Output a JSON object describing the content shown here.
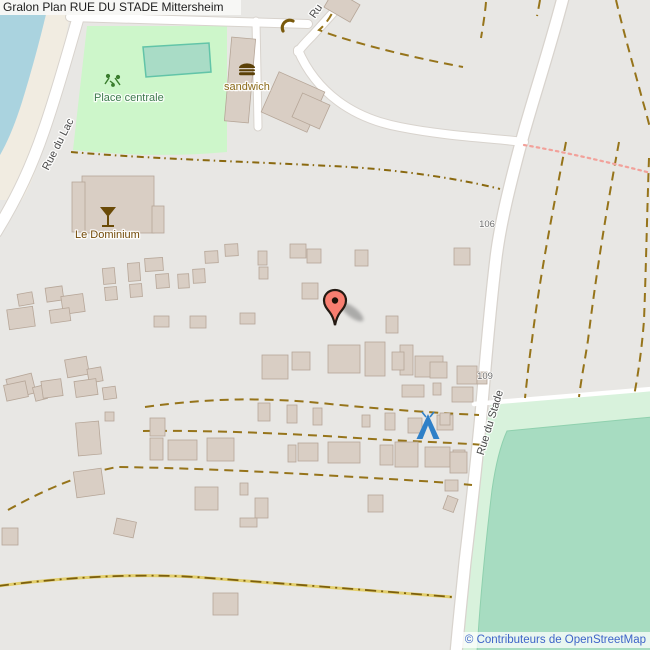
{
  "header": {
    "title": "Gralon Plan RUE DU STADE Mittersheim"
  },
  "attribution": {
    "text": "© Contributeurs de OpenStreetMap"
  },
  "map": {
    "labels": {
      "park": "Place centrale",
      "fast_food": "sandwich",
      "bar": "Le Dominium",
      "street_lac": "Rue du Lac",
      "street_stade": "Rue du Stade",
      "street_partial": "Ru",
      "housenumber_106": "106",
      "housenumber_109": "109"
    },
    "icons": {
      "marker": "map-pin",
      "campsite": "tent",
      "bar": "cocktail-glass",
      "fast_food": "burger",
      "phone": "telephone",
      "playground": "playground"
    },
    "colors": {
      "background": "#e8e7e4",
      "water": "#aad3df",
      "beach": "#f1ece1",
      "park": "#cdf6ca",
      "pitch_fill": "#a9dcc6",
      "pitch_stroke": "#62c4a8",
      "field_outer": "#d8f2dc",
      "field_inner": "#a7dcc1",
      "road": "#ffffff",
      "road_casing": "#d8d3cd",
      "building_fill": "#d9cec4",
      "building_stroke": "#b6a698",
      "path_dashed": "#96741a",
      "track_yellow": "#e3cf6d",
      "path_pink": "#f2a19a",
      "marker_fill": "#f87e70",
      "marker_stroke": "#241a12",
      "campsite_blue": "#2f80c8",
      "attribution_text": "#3d64c8"
    },
    "buildings": [
      [
        228,
        38,
        24,
        84,
        5
      ],
      [
        268,
        80,
        50,
        44,
        24
      ],
      [
        296,
        98,
        30,
        26,
        24
      ],
      [
        327,
        -4,
        30,
        20,
        30
      ],
      [
        82,
        176,
        72,
        57,
        0
      ],
      [
        72,
        182,
        13,
        50,
        0
      ],
      [
        152,
        206,
        12,
        27,
        0
      ],
      [
        18,
        293,
        15,
        12,
        -10
      ],
      [
        8,
        308,
        26,
        20,
        -8
      ],
      [
        46,
        287,
        17,
        14,
        -8
      ],
      [
        62,
        295,
        22,
        18,
        -8
      ],
      [
        50,
        309,
        20,
        13,
        -8
      ],
      [
        103,
        268,
        12,
        16,
        -5
      ],
      [
        105,
        287,
        12,
        13,
        -5
      ],
      [
        128,
        263,
        12,
        18,
        -4
      ],
      [
        130,
        284,
        12,
        13,
        -4
      ],
      [
        145,
        258,
        18,
        13,
        -4
      ],
      [
        156,
        274,
        13,
        14,
        -4
      ],
      [
        178,
        274,
        11,
        14,
        -3
      ],
      [
        193,
        269,
        12,
        14,
        -3
      ],
      [
        205,
        251,
        13,
        12,
        -3
      ],
      [
        225,
        244,
        13,
        12,
        -3
      ],
      [
        258,
        251,
        9,
        14,
        0
      ],
      [
        259,
        267,
        9,
        12,
        0
      ],
      [
        290,
        244,
        16,
        14,
        0
      ],
      [
        307,
        249,
        14,
        14,
        0
      ],
      [
        355,
        250,
        13,
        16,
        0
      ],
      [
        454,
        248,
        16,
        17,
        0
      ],
      [
        154,
        316,
        15,
        11,
        0
      ],
      [
        190,
        316,
        16,
        12,
        0
      ],
      [
        240,
        313,
        15,
        11,
        0
      ],
      [
        302,
        283,
        16,
        16,
        0
      ],
      [
        386,
        316,
        12,
        17,
        0
      ],
      [
        66,
        358,
        22,
        18,
        -10
      ],
      [
        88,
        368,
        14,
        14,
        -10
      ],
      [
        8,
        376,
        26,
        20,
        -14
      ],
      [
        34,
        386,
        12,
        14,
        -14
      ],
      [
        5,
        383,
        22,
        16,
        -12
      ],
      [
        42,
        380,
        20,
        17,
        -8
      ],
      [
        75,
        380,
        22,
        16,
        -8
      ],
      [
        103,
        387,
        13,
        12,
        -8
      ],
      [
        262,
        355,
        26,
        24,
        0
      ],
      [
        292,
        352,
        18,
        18,
        0
      ],
      [
        328,
        345,
        32,
        28,
        0
      ],
      [
        365,
        342,
        20,
        34,
        0
      ],
      [
        400,
        345,
        13,
        30,
        0
      ],
      [
        415,
        356,
        28,
        21,
        0
      ],
      [
        457,
        366,
        20,
        18,
        0
      ],
      [
        477,
        372,
        10,
        12,
        0
      ],
      [
        392,
        352,
        12,
        18,
        0
      ],
      [
        430,
        362,
        17,
        16,
        0
      ],
      [
        433,
        383,
        8,
        12,
        0
      ],
      [
        402,
        385,
        22,
        12,
        0
      ],
      [
        458,
        388,
        13,
        12,
        0
      ],
      [
        150,
        418,
        15,
        18,
        0
      ],
      [
        258,
        403,
        12,
        18,
        0
      ],
      [
        287,
        405,
        10,
        18,
        0
      ],
      [
        313,
        408,
        9,
        17,
        0
      ],
      [
        362,
        415,
        8,
        12,
        0
      ],
      [
        385,
        413,
        10,
        17,
        0
      ],
      [
        408,
        418,
        14,
        15,
        0
      ],
      [
        437,
        415,
        16,
        15,
        0
      ],
      [
        150,
        438,
        13,
        22,
        0
      ],
      [
        168,
        440,
        29,
        20,
        0
      ],
      [
        207,
        438,
        27,
        23,
        0
      ],
      [
        288,
        445,
        8,
        17,
        0
      ],
      [
        298,
        443,
        20,
        18,
        0
      ],
      [
        328,
        442,
        32,
        21,
        0
      ],
      [
        380,
        445,
        13,
        20,
        0
      ],
      [
        395,
        442,
        23,
        25,
        0
      ],
      [
        425,
        447,
        25,
        20,
        0
      ],
      [
        453,
        450,
        12,
        17,
        0
      ],
      [
        77,
        422,
        23,
        33,
        -5
      ],
      [
        105,
        412,
        9,
        9,
        0
      ],
      [
        75,
        470,
        28,
        26,
        -8
      ],
      [
        115,
        520,
        20,
        16,
        12
      ],
      [
        2,
        528,
        16,
        17,
        0
      ],
      [
        195,
        487,
        23,
        23,
        0
      ],
      [
        240,
        483,
        8,
        12,
        0
      ],
      [
        255,
        498,
        13,
        20,
        0
      ],
      [
        368,
        495,
        15,
        17,
        0
      ],
      [
        445,
        497,
        11,
        14,
        20
      ],
      [
        445,
        480,
        13,
        11,
        0
      ],
      [
        450,
        452,
        17,
        21,
        0
      ],
      [
        452,
        387,
        21,
        15,
        0
      ],
      [
        440,
        413,
        10,
        12,
        0
      ],
      [
        240,
        518,
        17,
        9,
        0
      ],
      [
        213,
        593,
        25,
        22,
        0
      ]
    ]
  }
}
